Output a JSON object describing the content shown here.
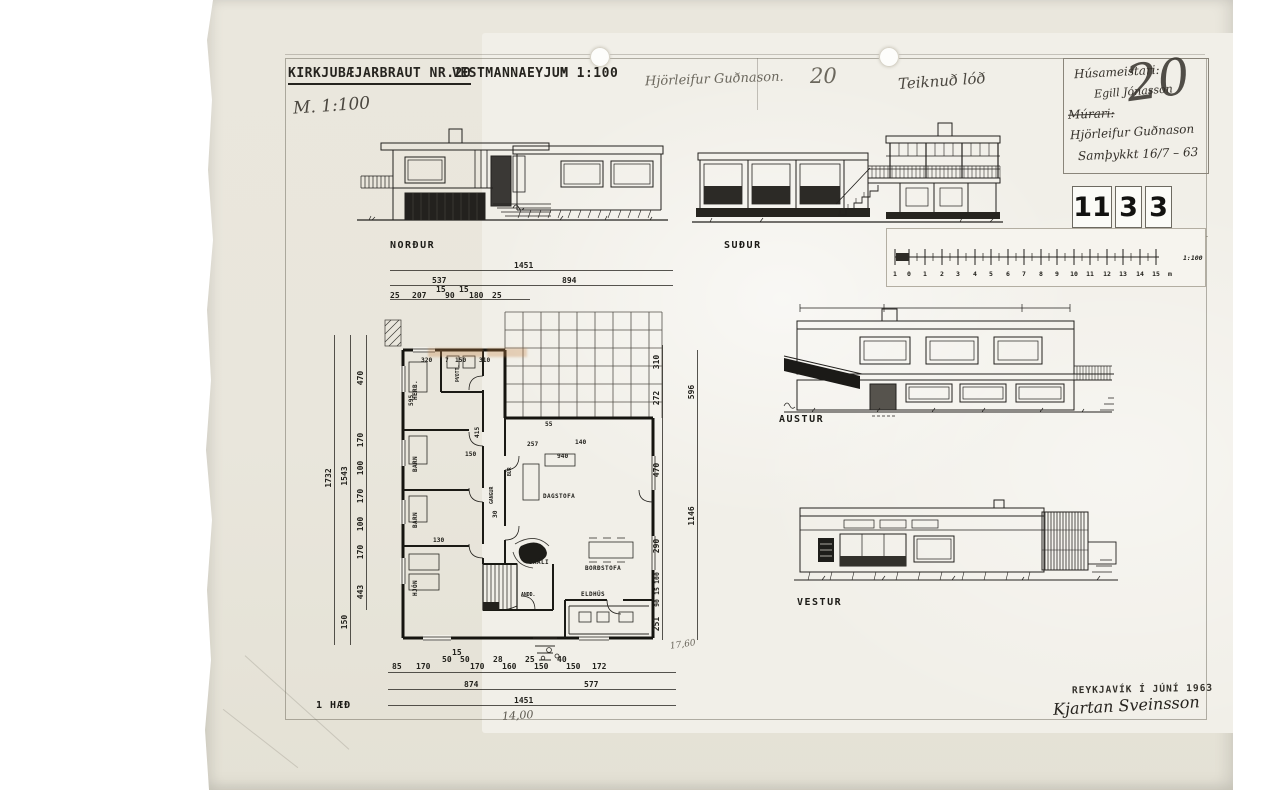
{
  "sheet": {
    "title": "KIRKJUBÆJARBRAUT NR.20",
    "location": "VESTMANNAEYJUM",
    "scale": "M 1:100",
    "floor_label": "1 HÆÐ",
    "stamp_city_date": "REYKJAVÍK Í JÚNÍ 1963",
    "signature": "Kjartan Sveinsson",
    "drawing_number": [
      "11",
      "3",
      "3"
    ]
  },
  "handwritten": {
    "scale_note": "M. 1:100",
    "architect_name": "Hjörleifur Guðnason.",
    "plot_number": "20",
    "note": "Teiknuð lóð",
    "plan_length": "14,00",
    "area_note": "17,60"
  },
  "info_box": {
    "line1": "Húsameistari:",
    "line2": "Egill Jónasson",
    "line3": "Múrari:",
    "line4": "Hjörleifur Guðnason",
    "line5": "Samþykkt 16/7 – 63",
    "overlay_number": "20"
  },
  "scale_bar": {
    "ticks": [
      "1",
      "0",
      "1",
      "2",
      "3",
      "4",
      "5",
      "6",
      "7",
      "8",
      "9",
      "10",
      "11",
      "12",
      "13",
      "14",
      "15"
    ],
    "unit": "m",
    "ratio": "1:100"
  },
  "elevations": {
    "north": "NORÐUR",
    "south": "SUÐUR",
    "east": "AUSTUR",
    "west": "VESTUR"
  },
  "plan": {
    "rooms": {
      "herb": "HERB.",
      "thvott": "ÞVOTT.",
      "gangur": "GANGUR",
      "barn1": "BARN",
      "barn2": "BARN",
      "hjon": "HJÓN",
      "bur": "BÚR",
      "skali": "SKÁLI",
      "andd": "ANDD.",
      "dagstofa": "DAGSTOFA",
      "bordstofa": "BORÐSTOFA",
      "eldhus": "ELDHÚS"
    },
    "dims": {
      "top_overall": "1451",
      "top_mid": [
        "537",
        "894"
      ],
      "top_chain": [
        "25",
        "207",
        "15",
        "90",
        "15",
        "180",
        "25"
      ],
      "bottom_chain": [
        "85",
        "170",
        "50",
        "15",
        "50",
        "170",
        "28",
        "160",
        "25",
        "150",
        "40",
        "150",
        "172"
      ],
      "bottom_mid": [
        "874",
        "577"
      ],
      "bottom_overall": "1451",
      "left_overall": "1732",
      "left_mid": "1543",
      "left_low": "150",
      "left_chain": [
        "470",
        "170",
        "100",
        "170",
        "100",
        "170",
        "443"
      ],
      "right_chain": [
        "310",
        "272",
        "470",
        "290",
        "251"
      ],
      "right_small": [
        "100",
        "15",
        "90"
      ],
      "right_outer": [
        "596",
        "1146"
      ],
      "interior": [
        "320",
        "7",
        "150",
        "310",
        "595",
        "415",
        "55",
        "257",
        "140",
        "940",
        "150",
        "130",
        "30"
      ]
    }
  }
}
